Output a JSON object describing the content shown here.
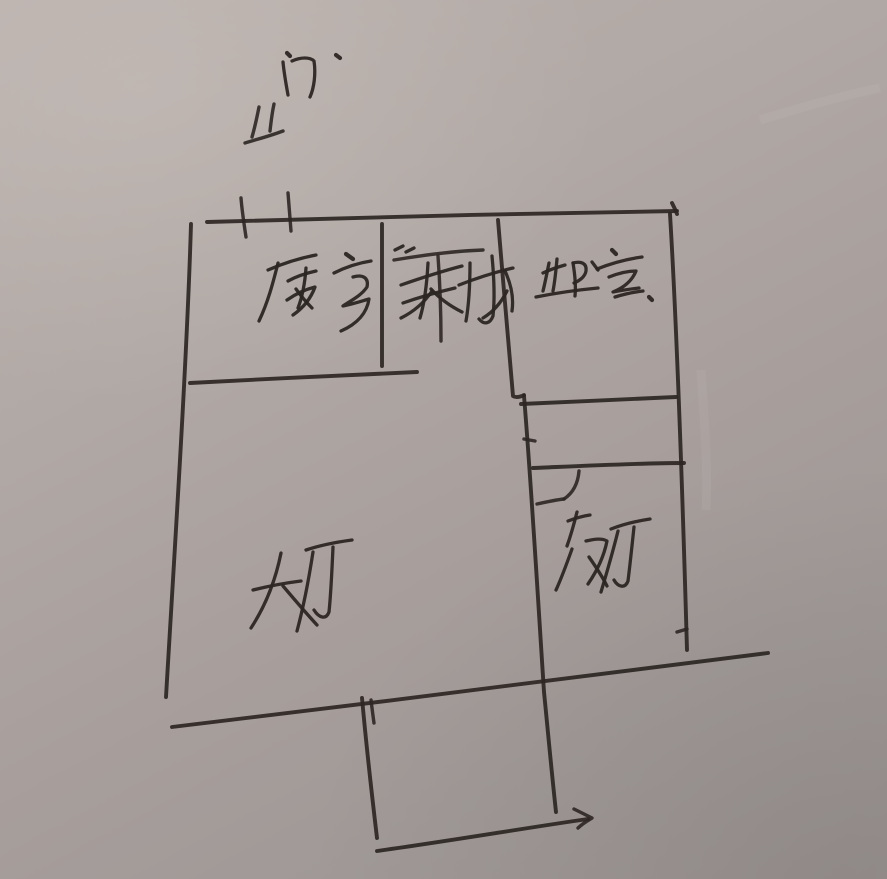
{
  "scene": {
    "kind": "hand-drawn floor plan sketch, black ink on gray paper",
    "ink_color": "#2c2623",
    "paper_color_light": "#bab1ad",
    "paper_color_dark": "#9b9492"
  },
  "labels": {
    "door": "门",
    "kitchen": "厨房",
    "stairs": "楼梯",
    "bedroom": "卧室",
    "hall": "大厅",
    "dining": "饭厅"
  },
  "marks": {
    "entry_symbol": "door-entry mark below 门 label",
    "door_ticks": "double tick marks on top wall (entry door)",
    "stair_symbol": "T-shaped stair mark",
    "door_swing": "quarter-arc door swing on hallway wall",
    "porch_arrow": "arrow at right end of bottom stub wall"
  }
}
